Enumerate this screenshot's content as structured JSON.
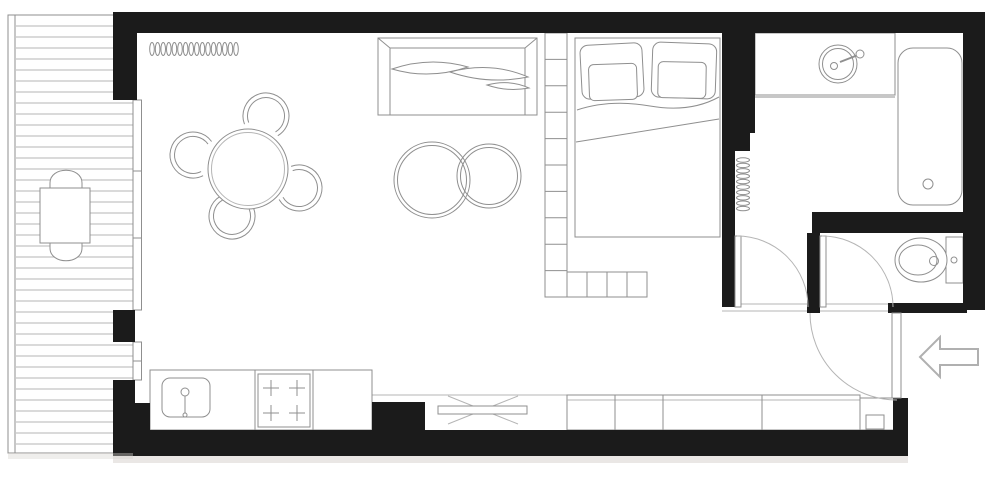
{
  "plan": {
    "kind": "studio-apartment-floor-plan",
    "rooms": [
      "balcony",
      "living-dining-area",
      "sleeping-area",
      "kitchen",
      "bathroom",
      "wc",
      "entry-hall"
    ]
  },
  "style": {
    "wall": "#1b1b1b",
    "line": "#8f8f8f",
    "line_light": "#b5b5b5",
    "white": "#ffffff",
    "shadow": "#d8d4d0",
    "arrow": "#b0b0b0"
  },
  "elements": [
    {
      "name": "balcony-outline",
      "kind": "rect",
      "x": 8,
      "y": 15,
      "w": 125,
      "h": 438,
      "fill": "white",
      "stroke": "line"
    },
    {
      "name": "balcony-railing-line",
      "kind": "line",
      "x1": 15,
      "y1": 15,
      "x2": 15,
      "y2": 453,
      "stroke": "line"
    },
    {
      "name": "balcony-decking",
      "kind": "stripes-h",
      "x": 16,
      "y": 26,
      "w": 117,
      "count": 39,
      "gap": 11,
      "stroke": "line_light"
    },
    {
      "name": "balcony-chair-top",
      "kind": "path",
      "d": "M 50,190 L 50,183 C 50,166 82,166 82,183 L 82,190 Z",
      "fill": "white",
      "stroke": "line"
    },
    {
      "name": "balcony-chair-bottom",
      "kind": "path",
      "d": "M 50,241 L 50,248 C 50,265 82,265 82,248 L 82,241 Z",
      "fill": "white",
      "stroke": "line"
    },
    {
      "name": "balcony-table",
      "kind": "rect",
      "x": 40,
      "y": 188,
      "w": 50,
      "h": 55,
      "fill": "white",
      "stroke": "line"
    },
    {
      "name": "window-balcony-upper",
      "kind": "rect",
      "x": 133,
      "y": 100,
      "w": 8.5,
      "h": 210,
      "fill": "white",
      "stroke": "line"
    },
    {
      "name": "window-balcony-upper-mullion-1",
      "kind": "line",
      "x1": 133,
      "y1": 171,
      "x2": 141.5,
      "y2": 171
    },
    {
      "name": "window-balcony-upper-mullion-2",
      "kind": "line",
      "x1": 133,
      "y1": 238,
      "x2": 141.5,
      "y2": 238
    },
    {
      "name": "window-balcony-lower",
      "kind": "rect",
      "x": 133,
      "y": 342,
      "w": 8.5,
      "h": 38,
      "fill": "white",
      "stroke": "line"
    },
    {
      "name": "window-balcony-lower-mullion",
      "kind": "line",
      "x1": 133,
      "y1": 361,
      "x2": 141.5,
      "y2": 361
    },
    {
      "name": "radiator-living",
      "kind": "coil-h",
      "x": 152,
      "y": 49,
      "count": 16,
      "gap": 5.6,
      "rx": 2.3,
      "ry": 6.5,
      "stroke": "line"
    },
    {
      "name": "dining-chair-top-outer",
      "kind": "path",
      "d": "M244.5,124.2 A23,23 0 1 1 277.8,135.7",
      "fill": "none"
    },
    {
      "name": "dining-chair-top-inner",
      "kind": "path",
      "d": "M248.7,122.6 A18.5,18.5 0 1 1 275.5,131.9",
      "fill": "none"
    },
    {
      "name": "dining-chair-left-outer",
      "kind": "path",
      "d": "M203.1,175.7 A23,23 0 1 1 211.6,141.5",
      "fill": "none"
    },
    {
      "name": "dining-chair-left-inner",
      "kind": "path",
      "d": "M201.1,171.6 A18.5,18.5 0 1 1 208,144.1",
      "fill": "none"
    },
    {
      "name": "dining-chair-right-outer",
      "kind": "path",
      "d": "M291.1,166.4 A23,23 0 1 1 279.1,199.5",
      "fill": "none"
    },
    {
      "name": "dining-chair-right-inner",
      "kind": "path",
      "d": "M292.7,170.6 A18.5,18.5 0 1 1 283,197.3",
      "fill": "none"
    },
    {
      "name": "dining-chair-bottom-outer",
      "kind": "path",
      "d": "M253.5,207.8 A23,23 0 1 1 220.2,196.3",
      "fill": "none"
    },
    {
      "name": "dining-chair-bottom-inner",
      "kind": "path",
      "d": "M249.3,209.4 A18.5,18.5 0 1 1 222.5,200.1",
      "fill": "none"
    },
    {
      "name": "dining-table",
      "kind": "circle",
      "cx": 248,
      "cy": 169,
      "r": 40,
      "fill": "white",
      "stroke": "line"
    },
    {
      "name": "dining-table-rim",
      "kind": "circle",
      "cx": 248,
      "cy": 169,
      "r": 36.5,
      "fill": "none",
      "stroke": "line_light"
    },
    {
      "name": "sofa-body",
      "kind": "rect",
      "x": 378,
      "y": 38,
      "w": 159,
      "h": 77,
      "fill": "white",
      "stroke": "line"
    },
    {
      "name": "sofa-back-line",
      "kind": "line",
      "x1": 390,
      "y1": 48,
      "x2": 525,
      "y2": 48
    },
    {
      "name": "sofa-arm-left",
      "kind": "line",
      "x1": 390,
      "y1": 48,
      "x2": 390,
      "y2": 115
    },
    {
      "name": "sofa-arm-right",
      "kind": "line",
      "x1": 525,
      "y1": 48,
      "x2": 525,
      "y2": 115
    },
    {
      "name": "sofa-corner-left",
      "kind": "line",
      "x1": 378,
      "y1": 38,
      "x2": 390,
      "y2": 48
    },
    {
      "name": "sofa-corner-right",
      "kind": "line",
      "x1": 537,
      "y1": 38,
      "x2": 525,
      "y2": 48
    },
    {
      "name": "sofa-cushion-1",
      "kind": "path",
      "d": "M392,69 Q430,56 468,67 Q429,80 392,69 Z",
      "fill": "white"
    },
    {
      "name": "sofa-cushion-2",
      "kind": "path",
      "d": "M450,72 Q491,61 528,77 Q488,85 450,72 Z",
      "fill": "white"
    },
    {
      "name": "sofa-cushion-3",
      "kind": "path",
      "d": "M487,85 Q509,79 529,88 Q507,92 487,85 Z",
      "fill": "white"
    },
    {
      "name": "coffee-table-large",
      "kind": "circle",
      "cx": 432,
      "cy": 180,
      "r": 38,
      "fill": "none"
    },
    {
      "name": "coffee-table-large-rim",
      "kind": "circle",
      "cx": 432,
      "cy": 180,
      "r": 34.5,
      "fill": "none"
    },
    {
      "name": "coffee-table-small",
      "kind": "circle",
      "cx": 489,
      "cy": 176,
      "r": 32,
      "fill": "none"
    },
    {
      "name": "coffee-table-small-rim",
      "kind": "circle",
      "cx": 489,
      "cy": 176,
      "r": 28.5,
      "fill": "none"
    },
    {
      "name": "shelf-divider-vertical",
      "kind": "rect",
      "x": 545,
      "y": 33,
      "w": 22,
      "h": 264,
      "fill": "white",
      "stroke": "line"
    },
    {
      "name": "shelf-divider-vertical-shelves",
      "kind": "stripes-h",
      "x": 545,
      "y": 59.4,
      "w": 22,
      "count": 9,
      "gap": 26.4,
      "stroke": "line"
    },
    {
      "name": "shelf-divider-bottom",
      "kind": "rect",
      "x": 567,
      "y": 272,
      "w": 80,
      "h": 25,
      "fill": "white",
      "stroke": "line"
    },
    {
      "name": "shelf-divider-bottom-d1",
      "kind": "line",
      "x1": 587,
      "y1": 272,
      "x2": 587,
      "y2": 297
    },
    {
      "name": "shelf-divider-bottom-d2",
      "kind": "line",
      "x1": 607,
      "y1": 272,
      "x2": 607,
      "y2": 297
    },
    {
      "name": "shelf-divider-bottom-d3",
      "kind": "line",
      "x1": 627,
      "y1": 272,
      "x2": 627,
      "y2": 297
    },
    {
      "name": "bed",
      "kind": "rect",
      "x": 575,
      "y": 38,
      "w": 145,
      "h": 199,
      "fill": "white",
      "stroke": "line"
    },
    {
      "name": "bed-pillow-left",
      "kind": "rect",
      "x": 581,
      "y": 44,
      "w": 62,
      "h": 54,
      "rx": 8,
      "fill": "white",
      "stroke": "line",
      "transform": "rotate(-3 612 71)"
    },
    {
      "name": "bed-pillow-left-inner",
      "kind": "rect",
      "x": 589,
      "y": 64,
      "w": 48,
      "h": 36,
      "rx": 5,
      "fill": "white",
      "stroke": "line",
      "transform": "rotate(-2 613 82)"
    },
    {
      "name": "bed-pillow-right",
      "kind": "rect",
      "x": 652,
      "y": 43,
      "w": 64,
      "h": 55,
      "rx": 8,
      "fill": "white",
      "stroke": "line",
      "transform": "rotate(2 684 70)"
    },
    {
      "name": "bed-pillow-right-inner",
      "kind": "rect",
      "x": 658,
      "y": 62,
      "w": 48,
      "h": 36,
      "rx": 5,
      "fill": "white",
      "stroke": "line",
      "transform": "rotate(1 682 80)"
    },
    {
      "name": "bed-sheet-fold",
      "kind": "path",
      "d": "M577,110 Q610,99 650,106 T719,97",
      "fill": "none"
    },
    {
      "name": "bed-blanket-line",
      "kind": "line",
      "x1": 576,
      "y1": 142,
      "x2": 719,
      "y2": 119
    },
    {
      "name": "media-ledge-line",
      "kind": "line",
      "x1": 372,
      "y1": 395,
      "x2": 567,
      "y2": 395,
      "stroke": "line_light"
    },
    {
      "name": "tv-cross-1",
      "kind": "line",
      "x1": 448,
      "y1": 396,
      "x2": 518,
      "y2": 424,
      "stroke": "line_light"
    },
    {
      "name": "tv-cross-2",
      "kind": "line",
      "x1": 448,
      "y1": 424,
      "x2": 518,
      "y2": 396,
      "stroke": "line_light"
    },
    {
      "name": "tv-stand",
      "kind": "rect",
      "x": 438,
      "y": 406,
      "w": 89,
      "h": 8,
      "fill": "white",
      "stroke": "line"
    },
    {
      "name": "wardrobe",
      "kind": "rect",
      "x": 567,
      "y": 395,
      "w": 293,
      "h": 35,
      "fill": "white",
      "stroke": "line"
    },
    {
      "name": "wardrobe-top-line",
      "kind": "line",
      "x1": 567,
      "y1": 400,
      "x2": 860,
      "y2": 400,
      "stroke": "line_light"
    },
    {
      "name": "wardrobe-divider-1",
      "kind": "line",
      "x1": 615,
      "y1": 395,
      "x2": 615,
      "y2": 430
    },
    {
      "name": "wardrobe-divider-2",
      "kind": "line",
      "x1": 663,
      "y1": 395,
      "x2": 663,
      "y2": 430
    },
    {
      "name": "wardrobe-divider-3",
      "kind": "line",
      "x1": 762,
      "y1": 395,
      "x2": 762,
      "y2": 430
    },
    {
      "name": "hall-cabinet",
      "kind": "rect",
      "x": 860,
      "y": 398,
      "w": 37,
      "h": 32,
      "fill": "white",
      "stroke": "line"
    },
    {
      "name": "hall-cabinet-inner",
      "kind": "rect",
      "x": 866,
      "y": 415,
      "w": 18,
      "h": 14,
      "fill": "none",
      "stroke": "line"
    },
    {
      "name": "kitchen-counter",
      "kind": "rect",
      "x": 150,
      "y": 370,
      "w": 222,
      "h": 60,
      "fill": "white",
      "stroke": "line"
    },
    {
      "name": "kitchen-counter-divider-1",
      "kind": "line",
      "x1": 255,
      "y1": 370,
      "x2": 255,
      "y2": 430
    },
    {
      "name": "kitchen-counter-divider-2",
      "kind": "line",
      "x1": 313,
      "y1": 370,
      "x2": 313,
      "y2": 430
    },
    {
      "name": "kitchen-sink",
      "kind": "rect",
      "x": 162,
      "y": 378,
      "w": 48,
      "h": 39,
      "rx": 8,
      "fill": "white",
      "stroke": "line"
    },
    {
      "name": "kitchen-faucet-head",
      "kind": "circle",
      "cx": 185,
      "cy": 392,
      "r": 4,
      "fill": "none"
    },
    {
      "name": "kitchen-faucet-stem",
      "kind": "line",
      "x1": 185,
      "y1": 396,
      "x2": 185,
      "y2": 413
    },
    {
      "name": "kitchen-faucet-base",
      "kind": "circle",
      "cx": 185,
      "cy": 415,
      "r": 2,
      "fill": "none"
    },
    {
      "name": "stove",
      "kind": "rect",
      "x": 258,
      "y": 374,
      "w": 52,
      "h": 53,
      "fill": "white",
      "stroke": "line"
    },
    {
      "name": "stove-burner-1",
      "kind": "path",
      "d": "M263,388 H279 M271,380 V396",
      "fill": "none"
    },
    {
      "name": "stove-burner-2",
      "kind": "path",
      "d": "M289,388 H305 M297,380 V396",
      "fill": "none"
    },
    {
      "name": "stove-burner-3",
      "kind": "path",
      "d": "M263,413 H279 M271,405 V421",
      "fill": "none"
    },
    {
      "name": "stove-burner-4",
      "kind": "path",
      "d": "M289,413 H305 M297,405 V421",
      "fill": "none"
    },
    {
      "name": "vanity-counter",
      "kind": "rect",
      "x": 755,
      "y": 33,
      "w": 140,
      "h": 62,
      "fill": "white",
      "stroke": "line"
    },
    {
      "name": "vanity-edge-line",
      "kind": "line",
      "x1": 755,
      "y1": 97,
      "x2": 895,
      "y2": 97
    },
    {
      "name": "vanity-sink",
      "kind": "circle",
      "cx": 838,
      "cy": 64,
      "r": 19,
      "fill": "white",
      "stroke": "line"
    },
    {
      "name": "vanity-sink-rim",
      "kind": "circle",
      "cx": 838,
      "cy": 64,
      "r": 15.5,
      "fill": "none"
    },
    {
      "name": "vanity-sink-drain",
      "kind": "circle",
      "cx": 834,
      "cy": 66,
      "r": 3.5,
      "fill": "none"
    },
    {
      "name": "vanity-faucet-lever",
      "kind": "line",
      "x1": 840,
      "y1": 62,
      "x2": 858,
      "y2": 55,
      "sw": 2
    },
    {
      "name": "vanity-faucet-knob",
      "kind": "circle",
      "cx": 860,
      "cy": 54,
      "r": 4,
      "fill": "white",
      "stroke": "line"
    },
    {
      "name": "bathtub",
      "kind": "rect",
      "x": 898,
      "y": 48,
      "w": 64,
      "h": 157,
      "rx": 15,
      "fill": "white",
      "stroke": "line"
    },
    {
      "name": "bathtub-drain",
      "kind": "circle",
      "cx": 928,
      "cy": 184,
      "r": 5,
      "fill": "none"
    },
    {
      "name": "radiator-bathroom",
      "kind": "coil-v",
      "x": 743,
      "y": 160,
      "count": 10,
      "gap": 5.4,
      "rx": 6.5,
      "ry": 2.2,
      "stroke": "line"
    },
    {
      "name": "toilet-tank",
      "kind": "rect",
      "x": 946,
      "y": 237,
      "w": 17,
      "h": 46,
      "fill": "white",
      "stroke": "line"
    },
    {
      "name": "toilet-bowl",
      "kind": "ellipse",
      "cx": 921,
      "cy": 260,
      "rx": 26,
      "ry": 22,
      "fill": "white",
      "stroke": "line"
    },
    {
      "name": "toilet-bowl-inner",
      "kind": "ellipse",
      "cx": 918,
      "cy": 260,
      "rx": 19,
      "ry": 15,
      "fill": "none"
    },
    {
      "name": "toilet-flush-button",
      "kind": "circle",
      "cx": 954,
      "cy": 260,
      "r": 3,
      "fill": "none"
    },
    {
      "name": "toilet-drain",
      "kind": "circle",
      "cx": 934,
      "cy": 261,
      "r": 4.5,
      "fill": "none"
    },
    {
      "name": "hall-threshold-upper",
      "kind": "line",
      "x1": 722,
      "y1": 304,
      "x2": 895,
      "y2": 304,
      "stroke": "line_light"
    },
    {
      "name": "hall-threshold-lower",
      "kind": "line",
      "x1": 722,
      "y1": 311,
      "x2": 895,
      "y2": 311,
      "stroke": "line_light"
    },
    {
      "name": "wall-top",
      "kind": "rect",
      "x": 113,
      "y": 12,
      "w": 872,
      "h": 21,
      "fill": "wall",
      "stroke": "none"
    },
    {
      "name": "wall-top-left-corner",
      "kind": "rect",
      "x": 113,
      "y": 12,
      "w": 24,
      "h": 88,
      "fill": "wall",
      "stroke": "none"
    },
    {
      "name": "wall-right",
      "kind": "rect",
      "x": 963,
      "y": 12,
      "w": 22,
      "h": 298,
      "fill": "wall",
      "stroke": "none"
    },
    {
      "name": "wall-bathroom-left-upper",
      "kind": "rect",
      "x": 722,
      "y": 33,
      "w": 33,
      "h": 100,
      "fill": "wall",
      "stroke": "none"
    },
    {
      "name": "wall-bathroom-left-step",
      "kind": "rect",
      "x": 735,
      "y": 133,
      "w": 15,
      "h": 18,
      "fill": "wall",
      "stroke": "none"
    },
    {
      "name": "wall-bathroom-left-lower",
      "kind": "rect",
      "x": 722,
      "y": 133,
      "w": 13,
      "h": 174,
      "fill": "wall",
      "stroke": "none"
    },
    {
      "name": "wall-wc-top",
      "kind": "rect",
      "x": 812,
      "y": 212,
      "w": 155,
      "h": 21,
      "fill": "wall",
      "stroke": "none"
    },
    {
      "name": "wall-wc-left",
      "kind": "rect",
      "x": 807,
      "y": 233,
      "w": 13,
      "h": 80,
      "fill": "wall",
      "stroke": "none"
    },
    {
      "name": "wall-wc-bottom",
      "kind": "rect",
      "x": 888,
      "y": 303,
      "w": 79,
      "h": 10,
      "fill": "wall",
      "stroke": "none"
    },
    {
      "name": "wall-entry-corner",
      "kind": "rect",
      "x": 893,
      "y": 398,
      "w": 15,
      "h": 35,
      "fill": "wall",
      "stroke": "none"
    },
    {
      "name": "wall-bottom",
      "kind": "rect",
      "x": 113,
      "y": 430,
      "w": 795,
      "h": 26,
      "fill": "wall",
      "stroke": "none"
    },
    {
      "name": "wall-bottom-step",
      "kind": "rect",
      "x": 372,
      "y": 402,
      "w": 53,
      "h": 30,
      "fill": "wall",
      "stroke": "none"
    },
    {
      "name": "wall-balcony-side-upper",
      "kind": "rect",
      "x": 113,
      "y": 310,
      "w": 22,
      "h": 32,
      "fill": "wall",
      "stroke": "none"
    },
    {
      "name": "wall-balcony-side-lower",
      "kind": "rect",
      "x": 113,
      "y": 380,
      "w": 22,
      "h": 52,
      "fill": "wall",
      "stroke": "none"
    },
    {
      "name": "wall-kitchen-step",
      "kind": "rect",
      "x": 135,
      "y": 403,
      "w": 15,
      "h": 29,
      "fill": "wall",
      "stroke": "none"
    },
    {
      "name": "bathroom-door-leaf",
      "kind": "rect",
      "x": 735,
      "y": 236,
      "w": 6,
      "h": 71,
      "fill": "white",
      "stroke": "line"
    },
    {
      "name": "bathroom-door-swing",
      "kind": "path",
      "d": "M737,236 A71,71 0 0 1 808,307",
      "fill": "none",
      "stroke": "line_light"
    },
    {
      "name": "wc-door-leaf",
      "kind": "rect",
      "x": 820,
      "y": 236,
      "w": 6,
      "h": 71,
      "fill": "white",
      "stroke": "line"
    },
    {
      "name": "wc-door-swing",
      "kind": "path",
      "d": "M822,236 A71,71 0 0 1 893,307",
      "fill": "none",
      "stroke": "line_light"
    },
    {
      "name": "entry-door-leaf",
      "kind": "rect",
      "x": 892,
      "y": 313,
      "w": 9,
      "h": 85,
      "fill": "white",
      "stroke": "line"
    },
    {
      "name": "entry-door-swing",
      "kind": "path",
      "d": "M810,313 A87,87 0 0 0 897,400",
      "fill": "none",
      "stroke": "line_light"
    },
    {
      "name": "entry-arrow",
      "kind": "polygon",
      "points": "920,357 940,337 940,349 978,349 978,365 940,365 940,377",
      "fill": "white",
      "stroke": "arrow",
      "sw": 2
    },
    {
      "name": "exterior-shadow-bottom",
      "kind": "rect",
      "x": 113,
      "y": 456,
      "w": 795,
      "h": 7,
      "fill": "shadow",
      "stroke": "none",
      "opacity": 0.55
    },
    {
      "name": "exterior-shadow-balcony",
      "kind": "rect",
      "x": 8,
      "y": 453,
      "w": 125,
      "h": 6,
      "fill": "shadow",
      "stroke": "none",
      "opacity": 0.4
    }
  ]
}
